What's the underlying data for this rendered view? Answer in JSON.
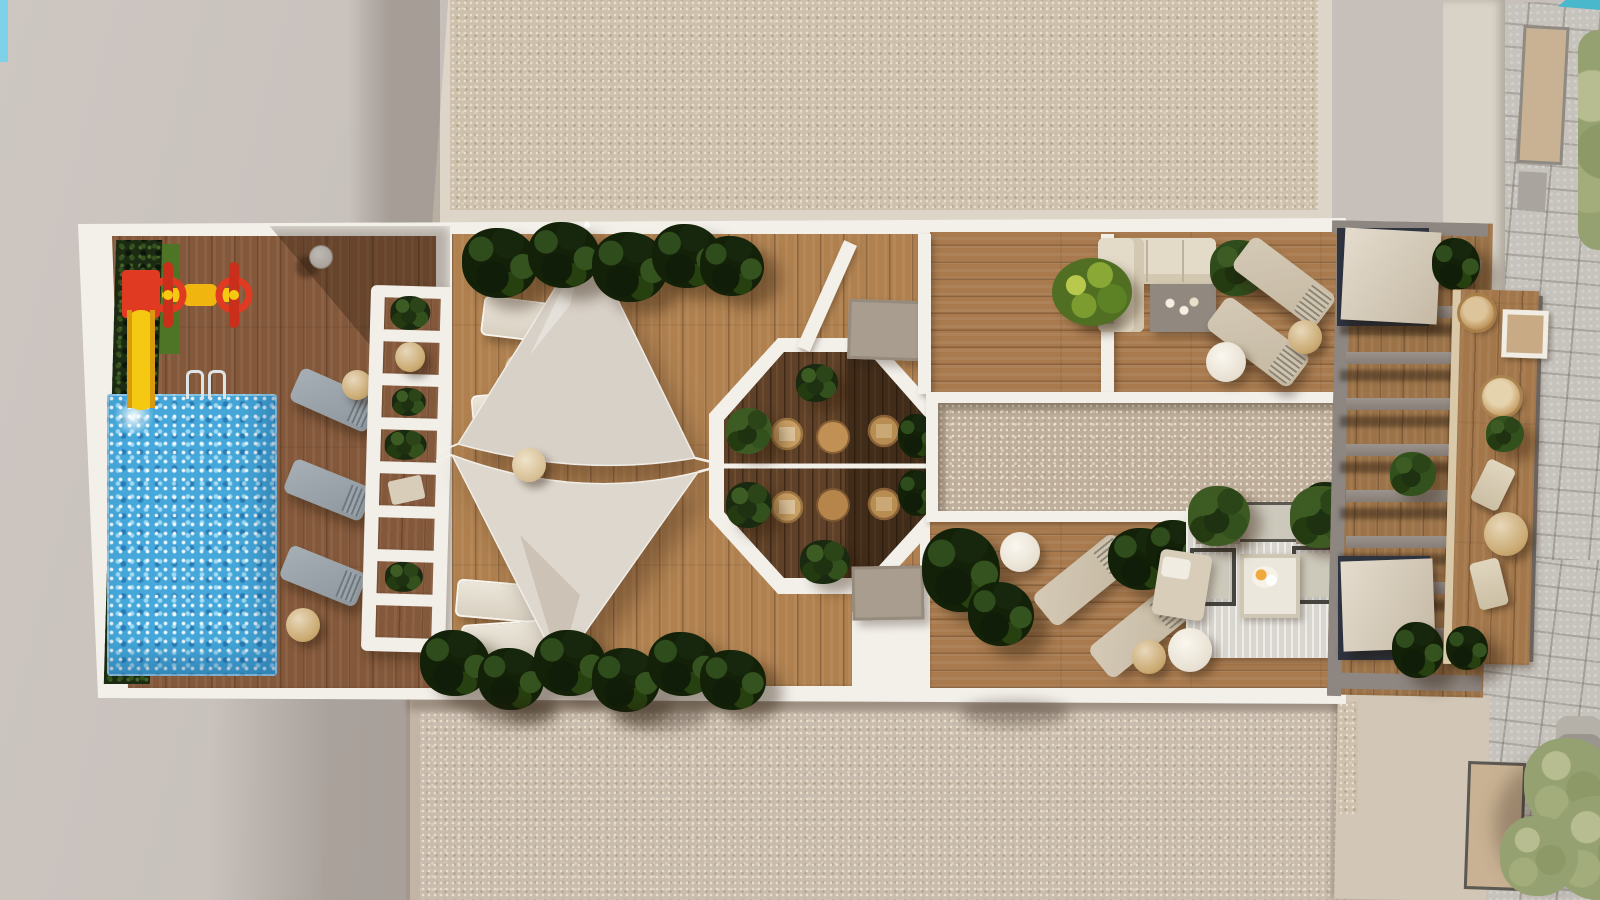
{
  "scene": {
    "type": "aerial-architectural-render",
    "setting": "Top-down 3D visualization of a residential rooftop terrace with communal amenities, flanked by gravel roofs, a street sidewalk, neighbouring rooftops, a tree and a parked car",
    "areas": [
      {
        "id": "pool-zone",
        "label": "Swimming pool zone with kids playground, hedge screen and grey sun loungers"
      },
      {
        "id": "sail-deck",
        "label": "Timber deck shaded by two triangular sail canopies with planters and white loungers"
      },
      {
        "id": "octagon-dining",
        "label": "Sunken octagonal dining nook with wicker chairs, round tables and shrubs"
      },
      {
        "id": "lounge-deck",
        "label": "Timber lounge deck with L-shaped sofa, chaise longues and outdoor living set on rug"
      },
      {
        "id": "skylight-strip",
        "label": "Central gravel skylight strip"
      },
      {
        "id": "pergola",
        "label": "Slatted pergola over stair cores with canvas covers"
      },
      {
        "id": "balcony-walk",
        "label": "Narrow furnished balcony strip along the street side"
      }
    ],
    "objects": {
      "pools": 1,
      "shade_sails": 2,
      "sun_loungers": 11,
      "dining_chairs": 4,
      "round_tables": 10,
      "sofas": 2,
      "armchairs": 2,
      "playground_units": 2,
      "shrubs_and_planters": 30,
      "stair_canopies": 2,
      "trees": 1,
      "cars": 1
    }
  },
  "palette": {
    "ground": "#c6bfba",
    "ground_light": "#ccc5c0",
    "shadow": "rgba(35,22,10,0.30)",
    "gravel_roof": "#cdc0ad",
    "gravel_low": "#c9bcae",
    "gravel_border": "#ddd5c8",
    "terrace_frame": "#f3f0ea",
    "deck_pool": "#84583a",
    "deck_sail": "#b0814f",
    "deck_lounge": "#a87a4e",
    "deck_balcony": "#a3774a",
    "octagon_floor": "#5e4128",
    "pool_water": "#46a8da",
    "hedge_green": "#1b2a12",
    "grass_green": "#4e7426",
    "slide_red": "#e03a22",
    "slide_yellow": "#f5c912",
    "sail_light": "#d8d1c7",
    "sail_lighter": "#ded7cd",
    "lounger_grey": "#99a2a9",
    "lounger_beige": "#cfc3ae",
    "white_lounger": "#e8e2d6",
    "sofa_cream": "#e3dbc8",
    "coffee_table_grey": "#91897f",
    "rug": "#d9d6cf",
    "planter_taupe": "#a89d8f",
    "wicker": "#c79e63",
    "pergola_grey": "#8e8680",
    "canopy_beige": "#d6c9b3",
    "stairwell_dark": "#2e3440",
    "stone_paving": "#c6c2bc",
    "roof_cream": "#d9d3c7",
    "skylight_tan": "#c9b293",
    "building_beige": "#d2c6b6",
    "tree_sage": "#96a172",
    "car_grey": "#9a958e",
    "neighbour_pool_teal": "#49b8cc"
  }
}
